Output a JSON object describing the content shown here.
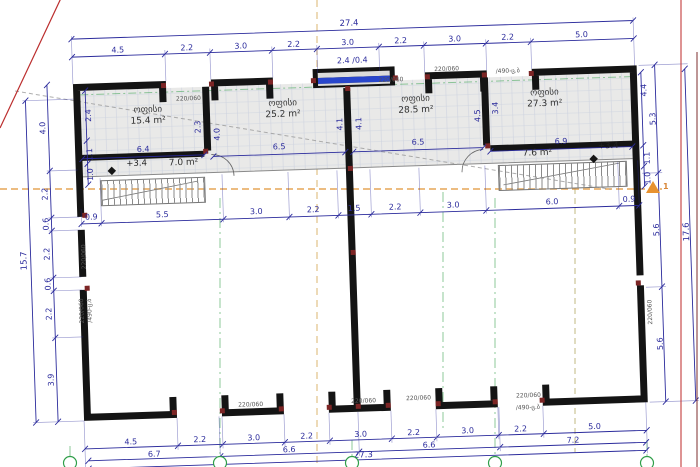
{
  "title": "floor-plan",
  "rooms": [
    {
      "name": "ოფისი",
      "area": "15.4 m²"
    },
    {
      "name": "ოფისი",
      "area": "25.2 m²"
    },
    {
      "name": "ოფისი",
      "area": "28.5 m²"
    },
    {
      "name": "ოფისი",
      "area": "27.3 m²"
    }
  ],
  "lobby": {
    "left_level": "+3.4",
    "left_area": "7.0 m²",
    "right_area": "7.6 m²",
    "right_level": "+3.4"
  },
  "top_window": {
    "label": "2.4 /0.4"
  },
  "wall_spec": {
    "size": "220/060",
    "type": "/490-ც.ბ"
  },
  "dims": {
    "top_total": "27.4",
    "top_segments": [
      "4.5",
      "2.2",
      "3.0",
      "2.2",
      "3.0",
      "2.2",
      "3.0",
      "2.2",
      "5.0"
    ],
    "band": [
      "6.4",
      "6.5",
      "6.5",
      "6.9"
    ],
    "mid": [
      "0.9",
      "5.5",
      "3.0",
      "2.2",
      "1.5",
      "2.2",
      "3.0",
      "6.0",
      "0.9"
    ],
    "left_total": "15.7",
    "left": [
      "4.0",
      "2.2",
      "0.6",
      "2.2",
      "0.6",
      "2.2",
      "3.9"
    ],
    "left_wall": [
      "2.4",
      "1.1",
      "1.0"
    ],
    "right": [
      "5.3",
      "5.6",
      "5.6"
    ],
    "right_total": "17.6",
    "right_wall": [
      "4.4",
      "1.1",
      "1.0"
    ],
    "wall_210": [
      "2.3",
      "4.0"
    ],
    "wall_352": [
      "4.1",
      "4.1"
    ],
    "wall_490": [
      "4.5",
      "3.4"
    ],
    "bottom_segments": [
      "4.5",
      "2.2",
      "3.0",
      "2.2",
      "3.0",
      "2.2",
      "3.0",
      "2.2",
      "5.0"
    ],
    "bottom_spans": [
      "6.7",
      "6.6",
      "6.6",
      "7.2"
    ],
    "bottom_total": "27.3"
  },
  "section_marker": "1",
  "colors": {
    "dimension": "#2b2b9c",
    "wall": "#141414",
    "axis_green": "#2f9e48",
    "axis_orange": "#d9953b",
    "construction_red": "#bb2d2d",
    "window_blue": "#2946cc",
    "band_fill": "#e9e9e8"
  }
}
